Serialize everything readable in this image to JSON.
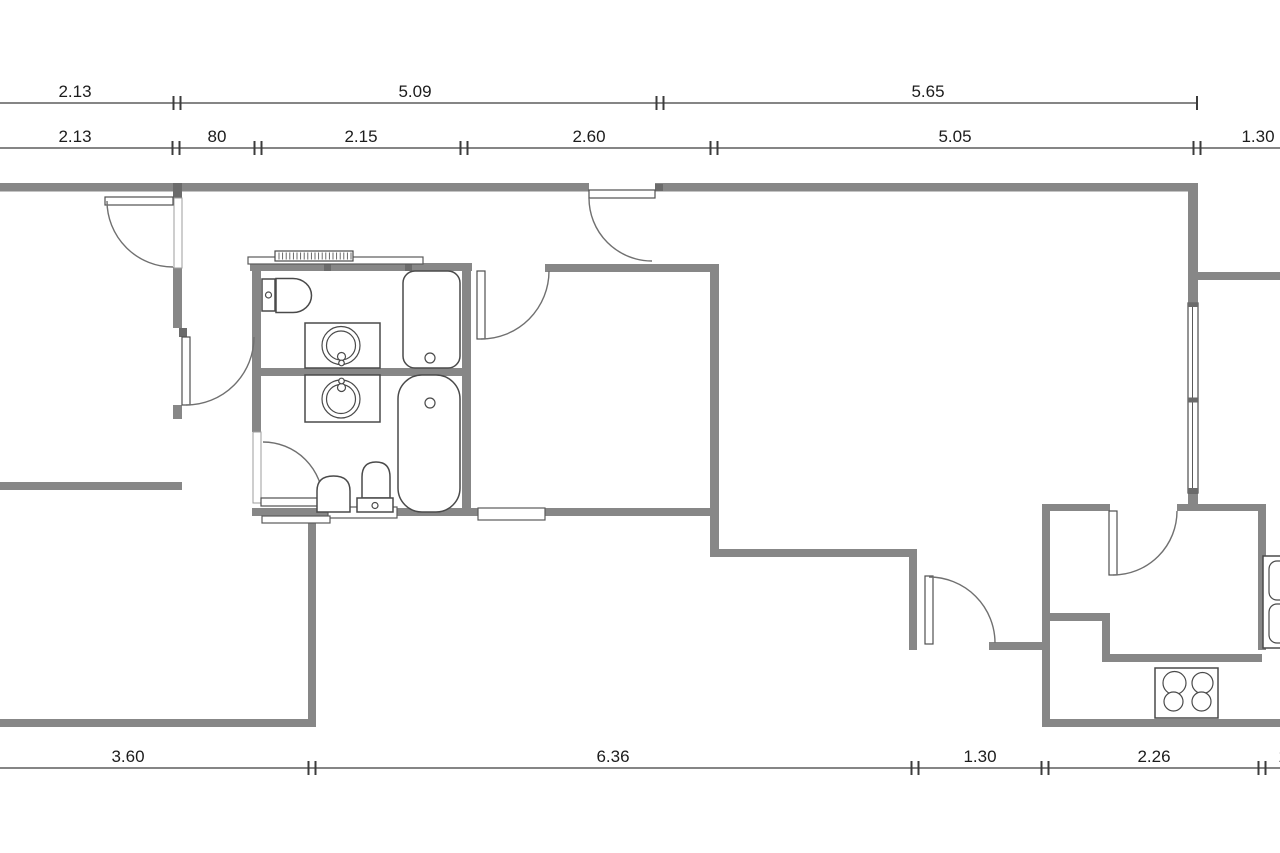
{
  "plan": {
    "type": "apartment-floor-plan",
    "colors": {
      "wall": "#878787",
      "stub": "#6b6b6b",
      "outline": "#4a4a4a",
      "arc": "#707070",
      "dim": "#3c3c3c",
      "text": "#1c1c1c",
      "background": "#ffffff"
    },
    "dimensions": {
      "top_outer": [
        "2.13",
        "5.09",
        "5.65"
      ],
      "top_inner": [
        "2.13",
        "80",
        "2.15",
        "2.60",
        "5.05",
        "1.30"
      ],
      "bottom": [
        "3.60",
        "6.36",
        "1.30",
        "2.26"
      ],
      "bottom_clipped": "1"
    },
    "fixtures": {
      "bathroom_upper": [
        "toilet",
        "washbasin",
        "bathtub",
        "radiator",
        "shelf"
      ],
      "bathroom_lower": [
        "washbasin",
        "bathtub",
        "toilet",
        "hand-basin"
      ],
      "kitchen": [
        "stove-four-burners",
        "double-sink",
        "counter"
      ],
      "windows": [
        "right-wall-window",
        "interior-sill-1",
        "interior-sill-2"
      ],
      "doors": [
        "entrance-door",
        "bedroom-door",
        "hallway-door",
        "middle-room-door",
        "wc-door",
        "hall-door",
        "kitchen-door"
      ]
    }
  }
}
